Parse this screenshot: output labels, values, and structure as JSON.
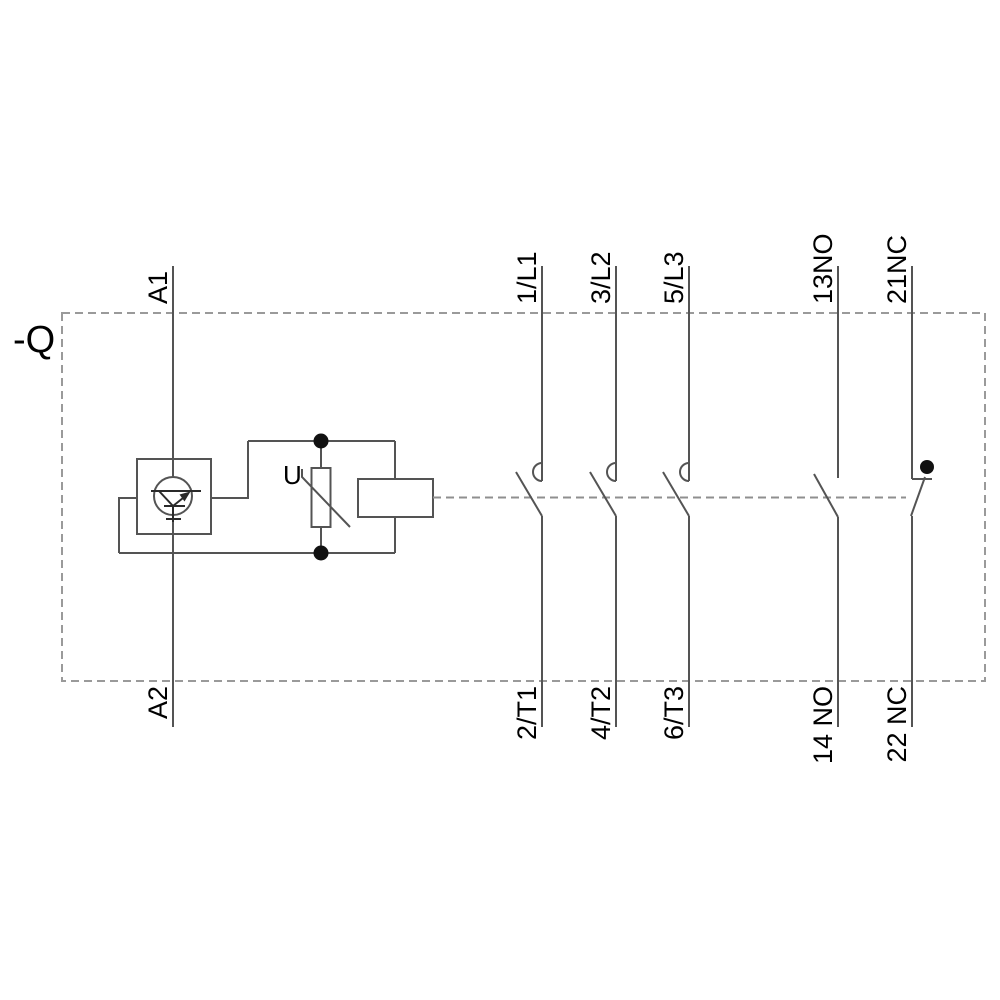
{
  "device_label": "-Q",
  "coil_circuit": {
    "terminal_top": "A1",
    "terminal_bottom": "A2",
    "varistor_label": "U"
  },
  "main_contacts": [
    {
      "top": "1/L1",
      "bottom": "2/T1"
    },
    {
      "top": "3/L2",
      "bottom": "4/T2"
    },
    {
      "top": "5/L3",
      "bottom": "6/T3"
    }
  ],
  "aux_contacts": [
    {
      "top": "13NO",
      "bottom": "14 NO",
      "type": "NO"
    },
    {
      "top": "21NC",
      "bottom": "22 NC",
      "type": "NC"
    }
  ],
  "colors": {
    "wire": "#545454",
    "border_dash": "#9a9a9a",
    "symbol": "#2a2a2a",
    "junction_dot": "#111111",
    "text": "#000000",
    "background": "#ffffff"
  }
}
